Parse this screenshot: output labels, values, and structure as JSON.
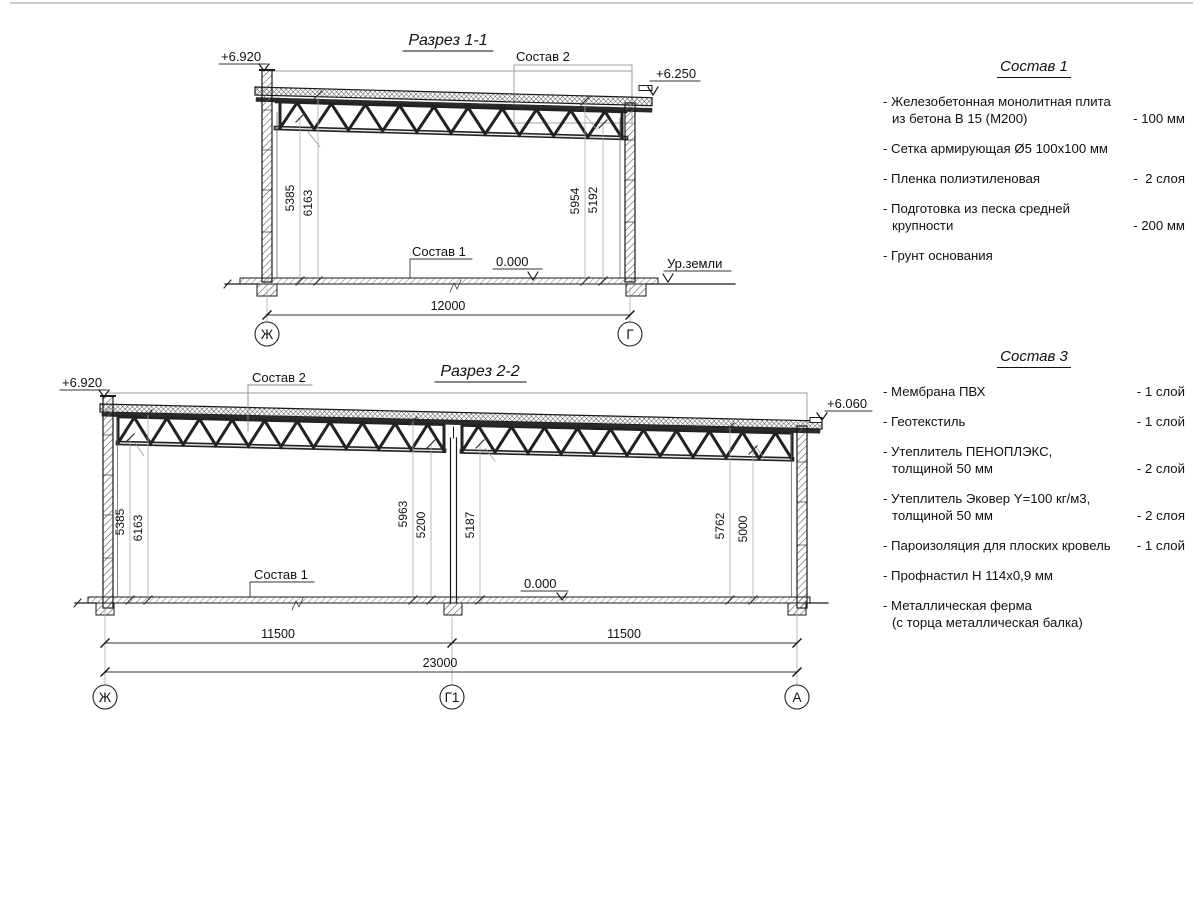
{
  "section1": {
    "title": "Разрез 1-1",
    "elev_left": "+6.920",
    "elev_right": "+6.250",
    "sostav2": "Состав 2",
    "sostav1": "Состав 1",
    "zero": "0.000",
    "ground": "Ур.земли",
    "dims": [
      "5385",
      "6163",
      "5954",
      "5192"
    ],
    "dim_width": "12000",
    "axis_left": "Ж",
    "axis_right": "Г"
  },
  "section2": {
    "title": "Разрез 2-2",
    "elev_left": "+6.920",
    "elev_right": "+6.060",
    "sostav2": "Состав 2",
    "sostav1": "Состав 1",
    "zero": "0.000",
    "dims": [
      "5385",
      "6163",
      "5963",
      "5200",
      "5187",
      "5762",
      "5000"
    ],
    "dim_left": "11500",
    "dim_right": "11500",
    "dim_total": "23000",
    "axes": [
      "Ж",
      "Г1",
      "А"
    ]
  },
  "legend1": {
    "title": "Состав 1",
    "items": [
      {
        "l1": "- Железобетонная  монолитная плита",
        "l2": "из бетона В 15 (М200)",
        "val": "- 100 мм"
      },
      {
        "l1": "- Сетка армирующая Ø5 100х100 мм",
        "l2": "",
        "val": ""
      },
      {
        "l1": "- Пленка полиэтиленовая",
        "l2": "",
        "val": "-  2 слоя"
      },
      {
        "l1": "- Подготовка из песка средней",
        "l2": "крупности",
        "val": "- 200 мм"
      },
      {
        "l1": "- Грунт основания",
        "l2": "",
        "val": ""
      }
    ]
  },
  "legend3": {
    "title": "Состав 3",
    "items": [
      {
        "l1": "- Мембрана ПВХ",
        "l2": "",
        "val": "- 1 слой"
      },
      {
        "l1": "- Геотекстиль",
        "l2": "",
        "val": "- 1 слой"
      },
      {
        "l1": "- Утеплитель ПЕНОПЛЭКС,",
        "l2": "толщиной 50 мм",
        "val": "- 2 слой"
      },
      {
        "l1": "- Утеплитель Эковер Y=100 кг/м3,",
        "l2": "толщиной 50 мм",
        "val": "- 2 слоя"
      },
      {
        "l1": "- Пароизоляция для плоских кровель",
        "l2": "",
        "val": "- 1 слой"
      },
      {
        "l1": "- Профнастил Н 114х0,9 мм",
        "l2": "",
        "val": ""
      },
      {
        "l1": "- Металлическая ферма",
        "l2": "(с торца металлическая балка)",
        "val": ""
      }
    ]
  }
}
